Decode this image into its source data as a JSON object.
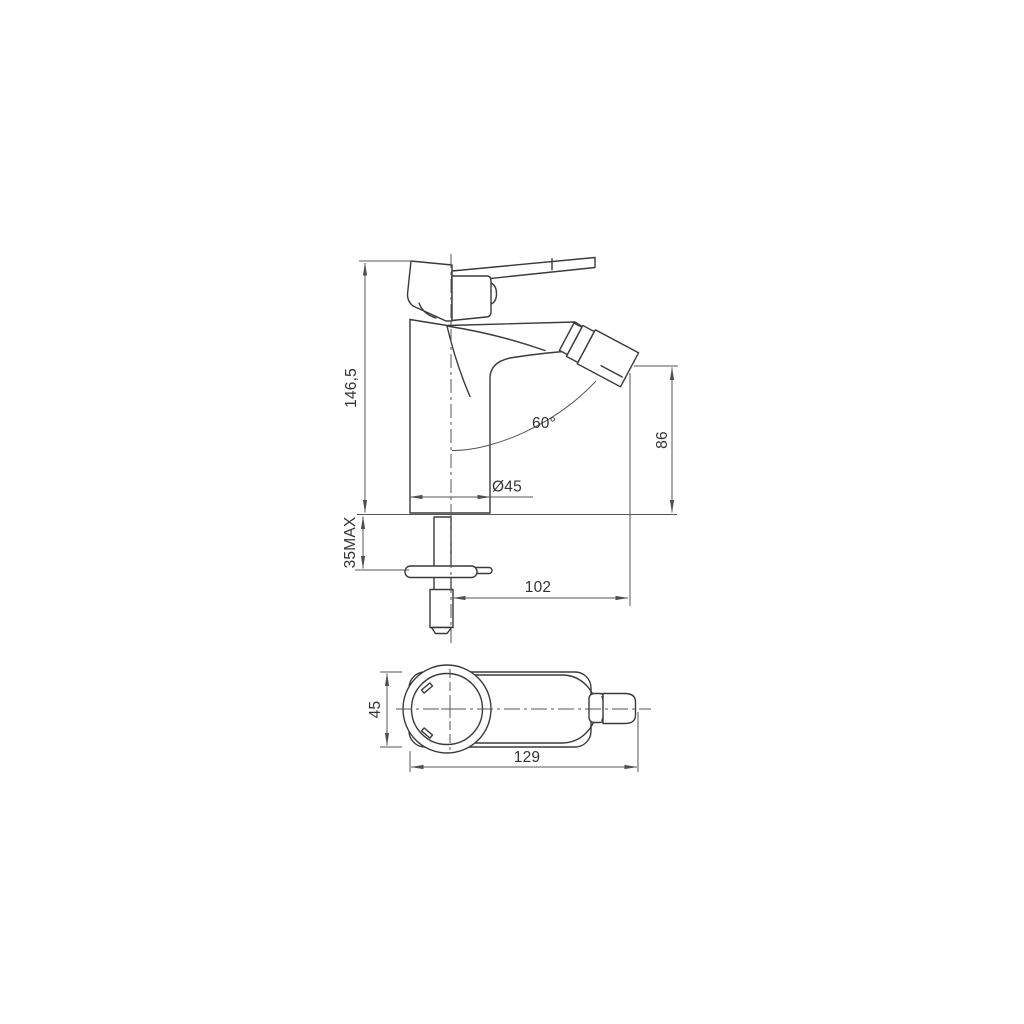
{
  "drawing": {
    "background_color": "#ffffff",
    "line_color": "#3a3a3a",
    "dimension_color": "#555555",
    "text_color": "#333333",
    "side_view": {
      "total_height_label": "146,5",
      "mounting_depth_label": "35MAX",
      "base_diameter_label": "Ø45",
      "spout_angle_label": "60°",
      "outlet_height_label": "86",
      "spout_reach_label": "102"
    },
    "top_view": {
      "body_width_label": "45",
      "total_length_label": "129"
    }
  }
}
